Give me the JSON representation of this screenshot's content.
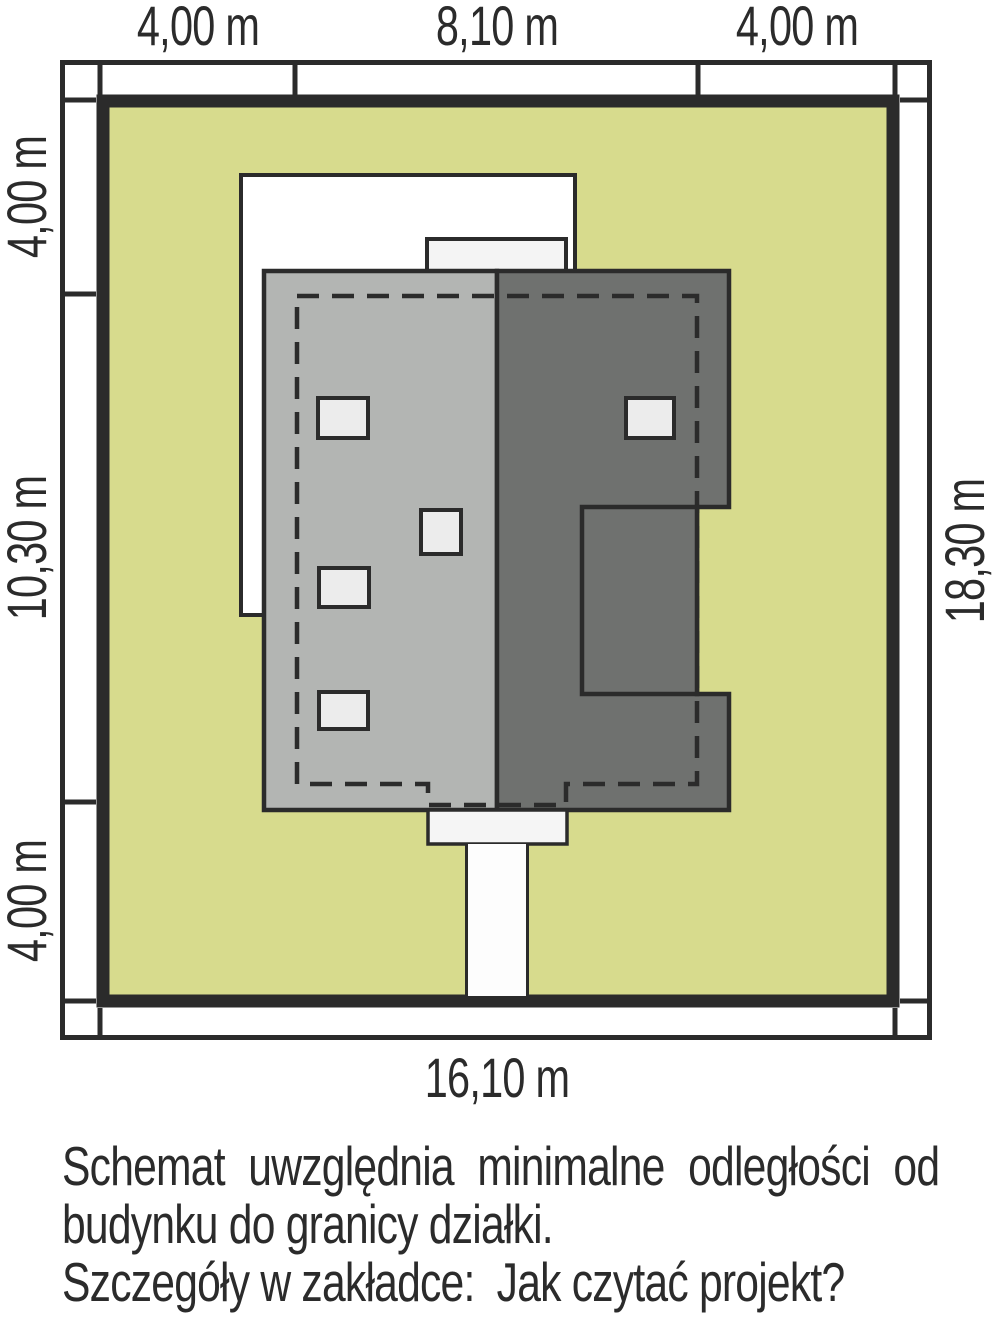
{
  "title": "Building site plan schematic (plot setback diagram)",
  "colors": {
    "page-bg": "#ffffff",
    "ink": "#2b2b2b",
    "plot-green": "#d7db8d",
    "roof-light": "#b3b5b3",
    "roof-dark": "#6f716f",
    "window-fill": "#ececec",
    "canopy-fill": "#f5f5f5",
    "terrace-fill": "#ffffff",
    "chimney-fill": "#f4f4f4",
    "path-fill": "#fdfdfd"
  },
  "dimensions": {
    "top": [
      "4,00 m",
      "8,10 m",
      "4,00 m"
    ],
    "left": [
      "4,00 m",
      "10,30 m",
      "4,00 m"
    ],
    "right": [
      "18,30 m"
    ],
    "bottom": [
      "16,10 m"
    ]
  },
  "plot": {
    "total_width_label": "16,10 m",
    "total_height_label": "18,30 m",
    "setback_top_label": "4,00 m",
    "setback_bottom_label": "4,00 m",
    "setback_left_label": "4,00 m",
    "setback_right_label": "4,00 m",
    "building_width_label": "8,10 m",
    "building_height_label": "10,30 m"
  },
  "footer": {
    "lines": [
      "Schemat uwzględnia minimalne odległości od",
      "budynku do granicy działki.",
      "Szczegóły w zakładce:  Jak czytać projekt?"
    ]
  }
}
